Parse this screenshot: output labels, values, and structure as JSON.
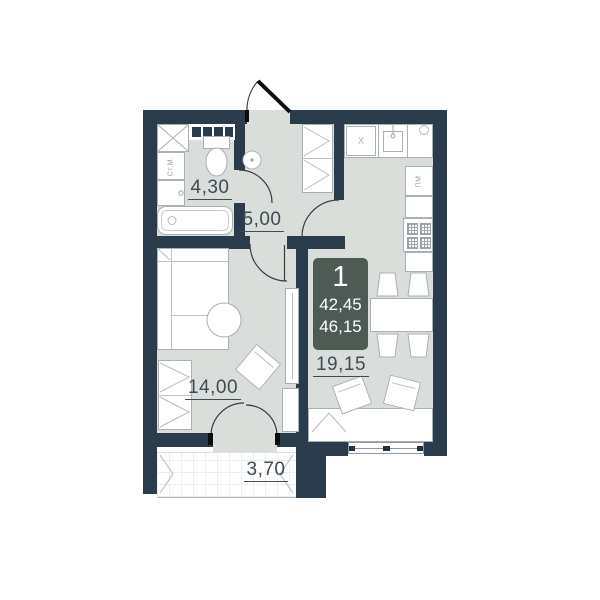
{
  "plan": {
    "title": "1-room apartment floor plan",
    "unit_badge": {
      "number": "1",
      "living_area": "42,45",
      "total_area": "46,15"
    },
    "rooms": [
      {
        "id": "bathroom",
        "area_label": "4,30"
      },
      {
        "id": "hallway",
        "area_label": "5,00"
      },
      {
        "id": "living-room",
        "area_label": "14,00"
      },
      {
        "id": "kitchen-living-room",
        "area_label": "19,15"
      },
      {
        "id": "balcony",
        "area_label": "3,70"
      }
    ],
    "appliance_labels": {
      "washing_machine": "Ст.М.",
      "dishwasher": "ПМ",
      "hob_mark": "X"
    },
    "colors": {
      "wall": "#2a3b4c",
      "floor": "#d9dedb",
      "badge": "#4e5b55",
      "label": "#3f4b55"
    }
  }
}
